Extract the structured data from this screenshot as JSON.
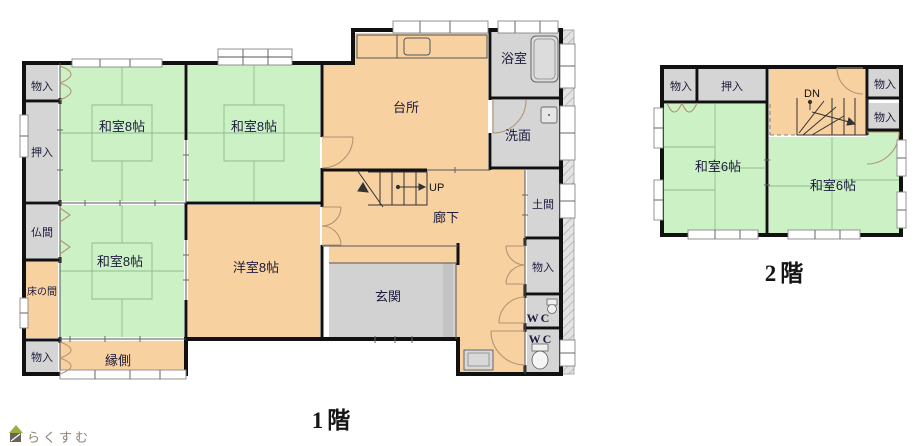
{
  "floor1": {
    "title": "1階",
    "rooms": {
      "monoire_tl": "物入",
      "oshiire": "押入",
      "butsuma": "仏間",
      "tokonoma": "床の間",
      "monoire_bl": "物入",
      "washitsu_a": "和室8帖",
      "washitsu_b": "和室8帖",
      "washitsu_c": "和室8帖",
      "yoshitsu": "洋室8帖",
      "engawa": "縁側",
      "daidokoro": "台所",
      "yokushitsu": "浴室",
      "senmen": "洗面",
      "rouka": "廊下",
      "genkan": "玄関",
      "doma": "土間",
      "monoire_r": "物入",
      "wc_upper": "WC",
      "wc_lower": "WC",
      "stairs_up": "UP"
    }
  },
  "floor2": {
    "title": "2階",
    "rooms": {
      "monoire_tl": "物入",
      "oshiire": "押入",
      "monoire_tr": "物入",
      "monoire_r": "物入",
      "washitsu_l": "和室6帖",
      "washitsu_r": "和室6帖",
      "stairs_dn": "DN"
    }
  },
  "branding": {
    "logo_text": "らくすむ"
  },
  "colors": {
    "tatami_green": "#cbf1c4",
    "wood_orange": "#f8d1a1",
    "service_gray": "#d5d5d5",
    "genkan_gray": "#d2d2d2",
    "counter_gray": "#cfcfcf",
    "wall_black": "#111111",
    "label_navy": "#1a1a3c",
    "door_arc_tan": "#b59474",
    "logo_brown": "#8d8173",
    "logo_roof_green": "#9aad3f"
  }
}
